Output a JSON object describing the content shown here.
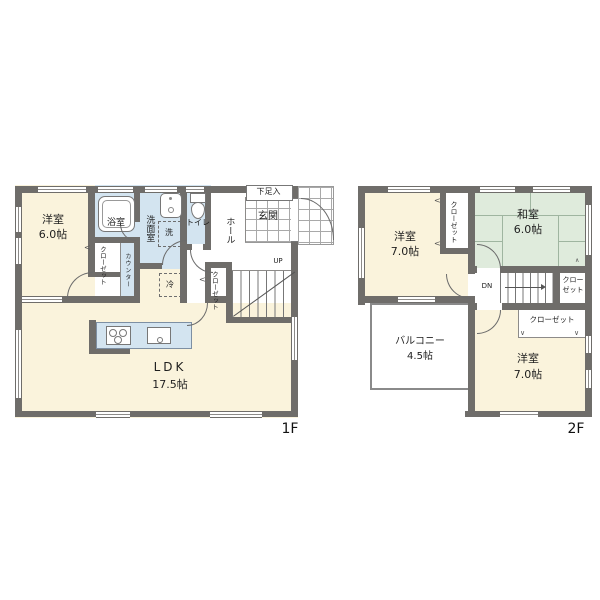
{
  "colors": {
    "wall": "#6F6D6A",
    "room_cream": "#FAF3DC",
    "wet_blue": "#D3E4F0",
    "tatami_green": "#DFEBDC",
    "grid_line": "#A9A9A9"
  },
  "floor1": {
    "label": "1F",
    "youshitsu": {
      "l1": "洋室",
      "l2": "6.0帖"
    },
    "bath": "浴室",
    "washroom": "洗面室",
    "toilet": "トイレ",
    "hall": "ホール",
    "entrance": "玄関",
    "shoe_cabinet": "下足入",
    "closet_bath": "クローゼット",
    "counter": "カウンター",
    "closet_stairs": "クローゼット",
    "ldk": {
      "l1": "LDK",
      "l2": "17.5帖"
    },
    "stairs_up": "UP",
    "washer": "洗",
    "fridge": "冷"
  },
  "floor2": {
    "label": "2F",
    "youshitsu_nw": {
      "l1": "洋室",
      "l2": "7.0帖"
    },
    "washitsu": {
      "l1": "和室",
      "l2": "6.0帖"
    },
    "youshitsu_se": {
      "l1": "洋室",
      "l2": "7.0帖"
    },
    "balcony": {
      "l1": "バルコニー",
      "l2": "4.5帖"
    },
    "closet_nw": "クローゼット",
    "closet_mid": {
      "l1": "クロー",
      "l2": "ゼット"
    },
    "closet_se": "クローゼット",
    "stairs_dn": "DN"
  },
  "marks": {
    "swing_left": "<",
    "swing_down": "∨",
    "fold": "∧"
  }
}
